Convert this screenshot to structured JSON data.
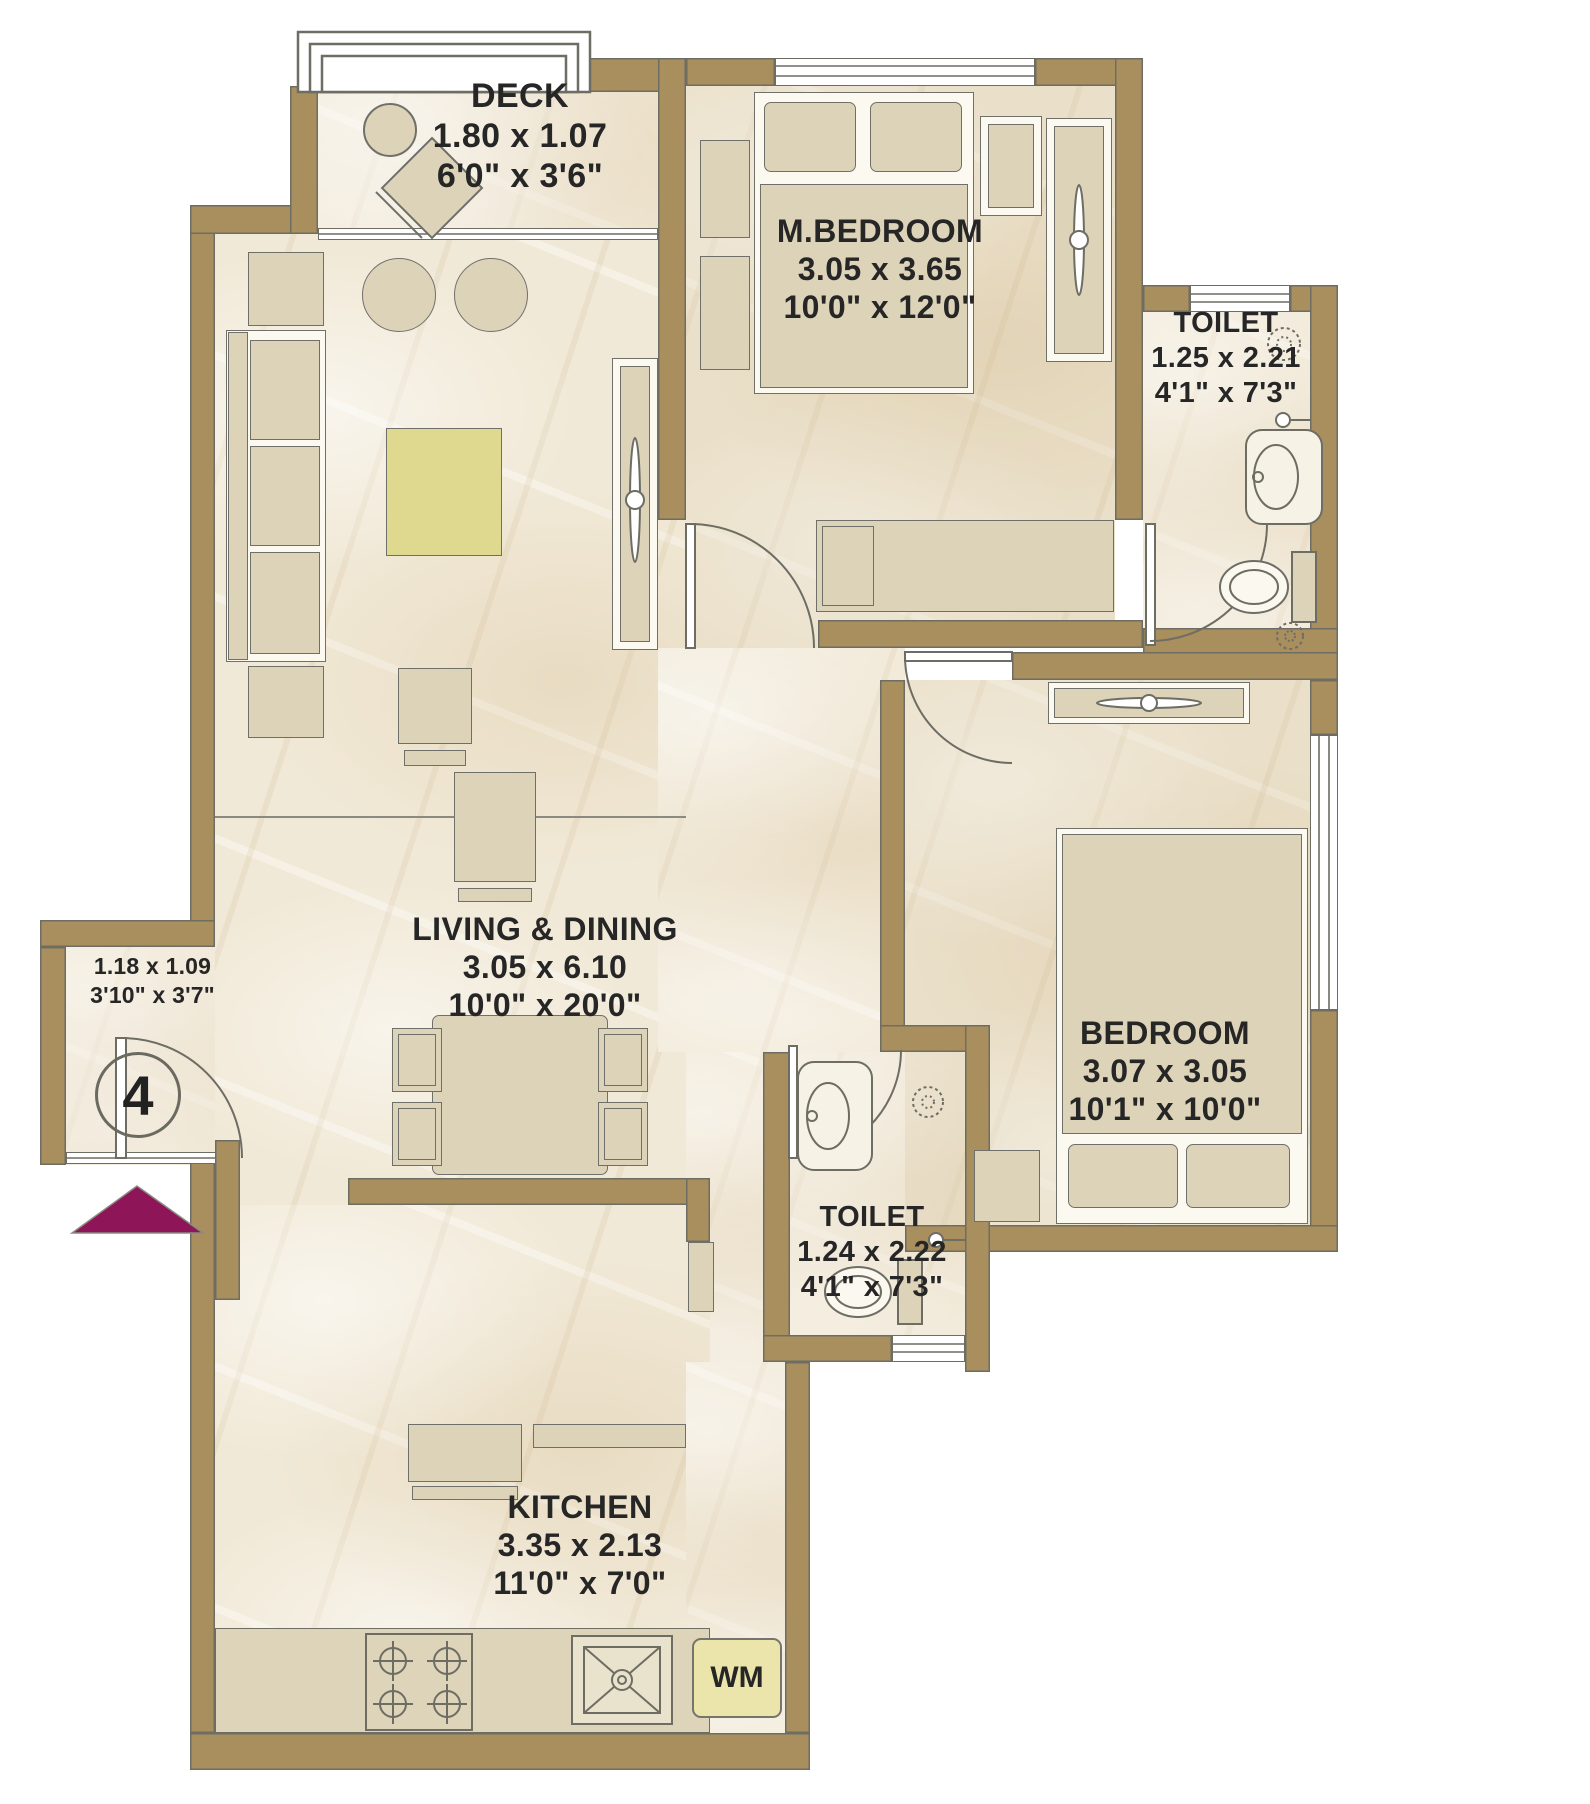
{
  "plan": {
    "rooms": {
      "deck": {
        "name": "DECK",
        "dim_m": "1.80 x 1.07",
        "dim_ft": "6'0\" x 3'6\""
      },
      "master_bedroom": {
        "name": "M.BEDROOM",
        "dim_m": "3.05 x 3.65",
        "dim_ft": "10'0\" x 12'0\""
      },
      "toilet_master": {
        "name": "TOILET",
        "dim_m": "1.25 x 2.21",
        "dim_ft": "4'1\" x 7'3\""
      },
      "living_dining": {
        "name": "LIVING & DINING",
        "dim_m": "3.05 x 6.10",
        "dim_ft": "10'0\" x 20'0\""
      },
      "bedroom": {
        "name": "BEDROOM",
        "dim_m": "3.07 x 3.05",
        "dim_ft": "10'1\" x 10'0\""
      },
      "toilet_common": {
        "name": "TOILET",
        "dim_m": "1.24 x 2.22",
        "dim_ft": "4'1\" x 7'3\""
      },
      "kitchen": {
        "name": "KITCHEN",
        "dim_m": "3.35 x 2.13",
        "dim_ft": "11'0\" x 7'0\""
      }
    },
    "entrance": {
      "dim_m": "1.18 x 1.09",
      "dim_ft": "3'10\" x 3'7\"",
      "unit_number": "4"
    },
    "appliances": {
      "washing_machine": "WM"
    },
    "colors": {
      "wall": "#a98e5e",
      "floor": "#f1e9d7",
      "furniture": "#ddd3b9",
      "accent_arrow": "#8e1558",
      "wm_fill": "#ece5ab",
      "text": "#262626"
    }
  }
}
